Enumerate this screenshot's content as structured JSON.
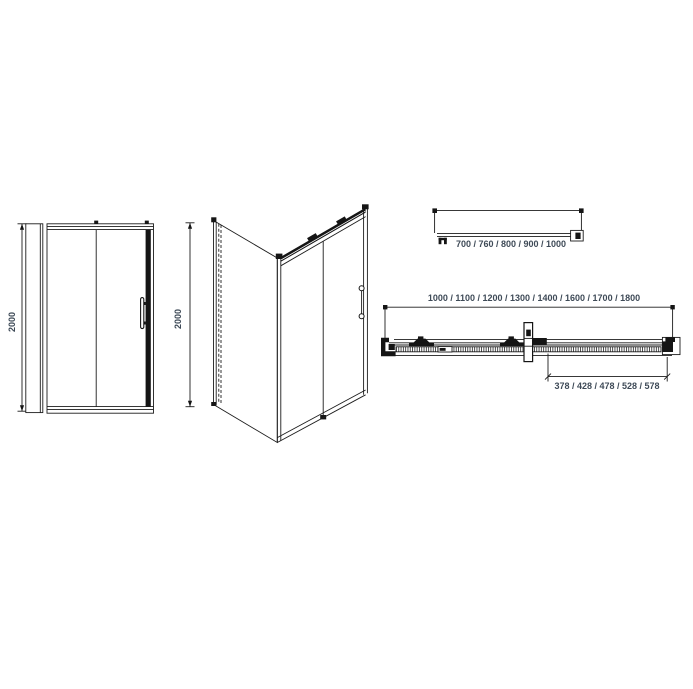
{
  "colors": {
    "background": "#ffffff",
    "line": "#1c1c1c",
    "dimension_text": "#3e4a57"
  },
  "views": {
    "front_elevation": {
      "height_dimension": "2000"
    },
    "perspective": {
      "height_dimension": "2000"
    },
    "side_panel_plan": {
      "width_options": "700 / 760 / 800 / 900 / 1000"
    },
    "door_plan": {
      "overall_width_options": "1000 / 1100 / 1200 / 1300 / 1400 / 1600 / 1700 / 1800",
      "opening_width_options": "378 / 428 / 478 / 528 / 578"
    }
  }
}
